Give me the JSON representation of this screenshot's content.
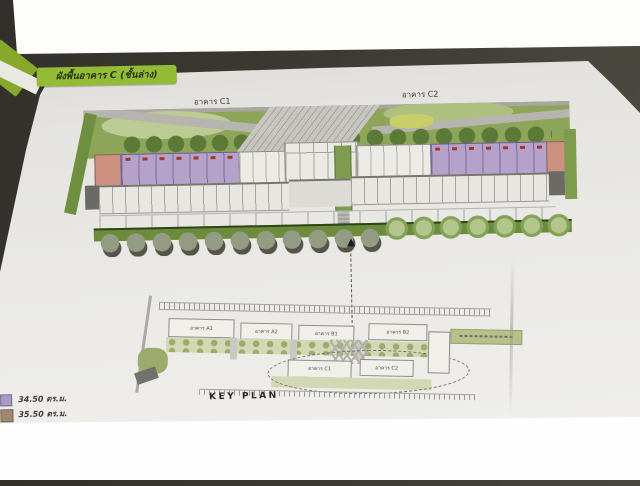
{
  "photo": {
    "background_color": "#3d3a33",
    "overexposure_color": "#fefefe",
    "paper_color": "#e8e7e3"
  },
  "page": {
    "title_banner": {
      "text": "ผังพื้นอาคาร C (ชั้นล่าง)",
      "bg_color": "#93bb35"
    },
    "floor_plan": {
      "building_labels": [
        {
          "label": "อาคาร C1"
        },
        {
          "label": "อาคาร C2"
        }
      ],
      "unit_colors": {
        "purple_unit": "#b4a2cb",
        "pink_unit": "#cd9181"
      },
      "c1_units": {
        "pink_count": 1,
        "purple_count": 7
      },
      "c2_units": {
        "purple_count": 7,
        "pink_count": 1
      }
    },
    "key_plan": {
      "title": "KEY PLAN",
      "buildings": [
        {
          "label": "อาคาร A1"
        },
        {
          "label": "อาคาร A2"
        },
        {
          "label": "อาคาร B1"
        },
        {
          "label": "อาคาร B2"
        },
        {
          "label": "อาคาร C1"
        },
        {
          "label": "อาคาร C2"
        }
      ]
    },
    "legend": {
      "items": [
        {
          "color": "#a89bc1",
          "area": "34.50 ตร.ม."
        },
        {
          "color": "#a18873",
          "area": "35.50 ตร.ม."
        }
      ]
    }
  }
}
